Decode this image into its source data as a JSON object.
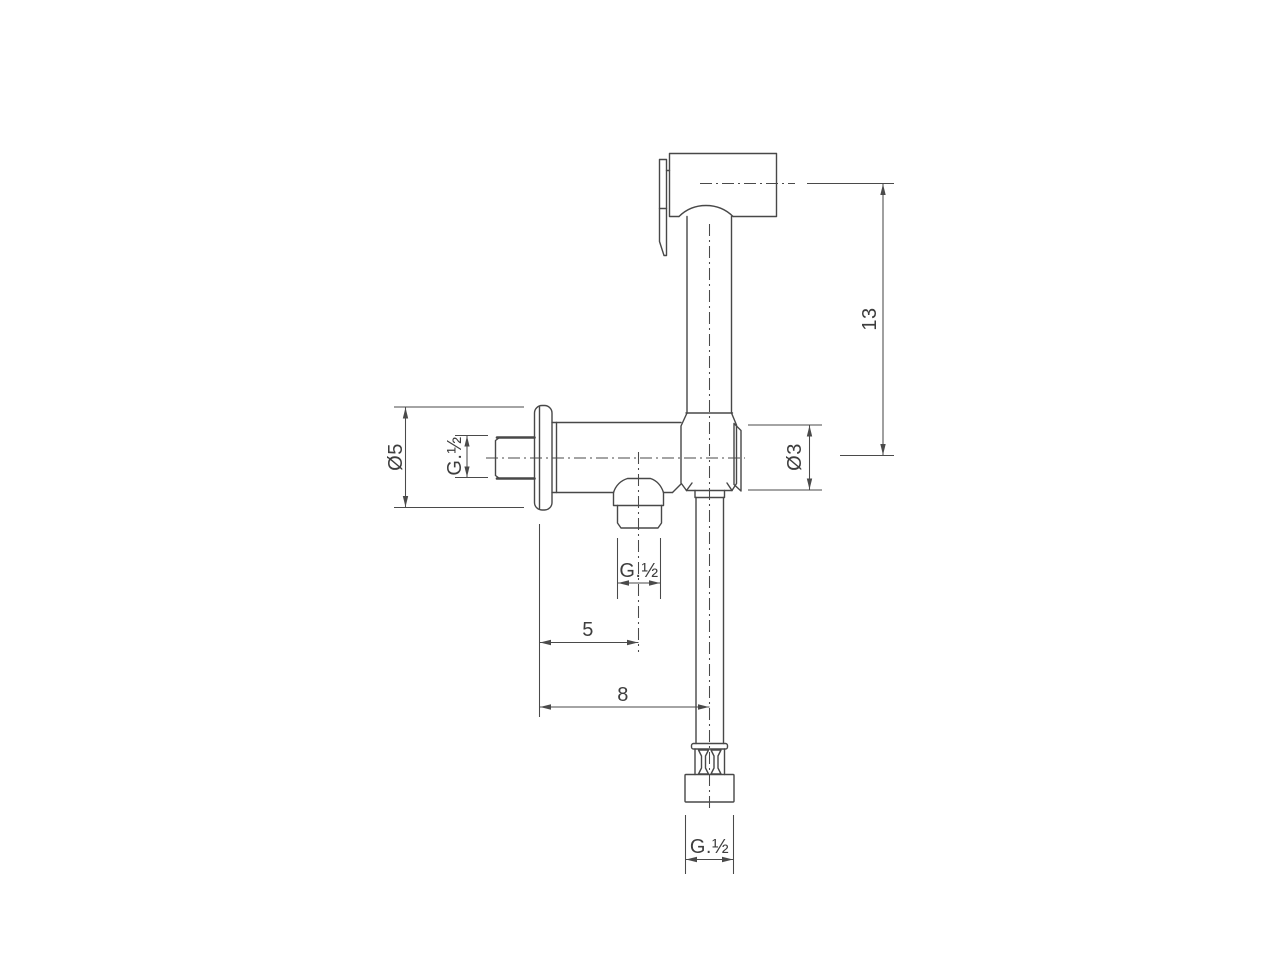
{
  "drawing": {
    "background_color": "#ffffff",
    "line_color": "#484848",
    "dimension_color": "#4a4a4a",
    "text_color": "#3e3e3e",
    "labels": {
      "flange_diameter": "Ø5",
      "inlet_thread": "G.½",
      "grip_diameter": "Ø3",
      "total_height": "13",
      "outlet_offset": "5",
      "hose_offset": "8",
      "outlet_thread": "G.½",
      "hose_thread": "G.½"
    }
  }
}
